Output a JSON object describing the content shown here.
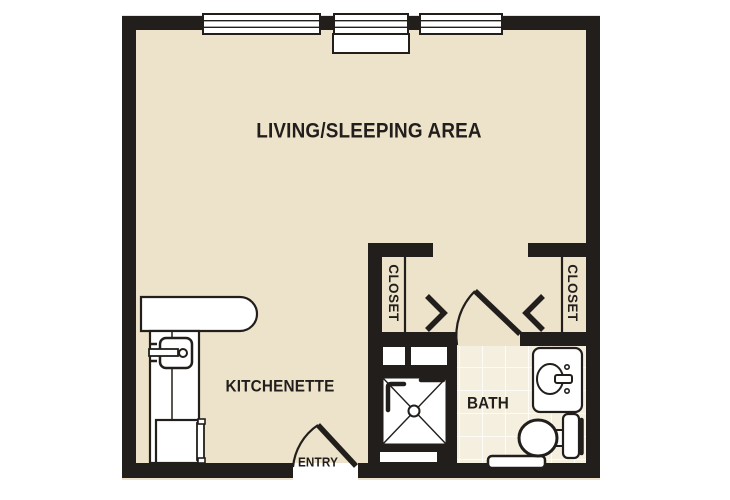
{
  "plan": {
    "labels": {
      "living": "LIVING/SLEEPING AREA",
      "kitchenette": "KITCHENETTE",
      "bath": "BATH",
      "entry": "ENTRY",
      "closet_left": "CLOSET",
      "closet_right": "CLOSET"
    },
    "colors": {
      "wall": "#221E1B",
      "floor": "#EDE3CB",
      "tile_floor": "#F5EFDF",
      "tile_grout": "#FFFFFF",
      "fixture_fill": "#FFFFFF",
      "background": "#FFFFFF"
    },
    "fixtures": [
      "window",
      "window-sill",
      "entry-door",
      "bath-door",
      "bifold-closet-door",
      "kitchen-counter",
      "kitchen-sink",
      "faucet",
      "refrigerator",
      "shower",
      "shower-drain",
      "grab-bar",
      "vanity-sink",
      "toilet",
      "baseboard-heater"
    ]
  }
}
